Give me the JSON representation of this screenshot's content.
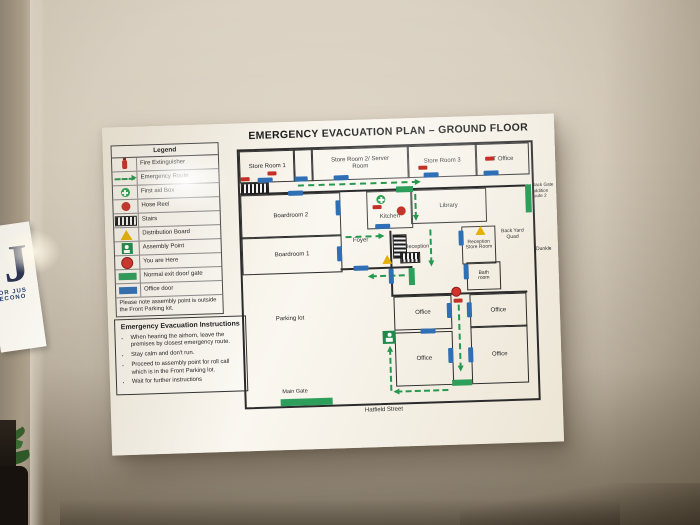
{
  "wall": {
    "sign_letter": "J",
    "sign_line1": "OR JUS",
    "sign_line2": "ECONO"
  },
  "poster": {
    "title": "EMERGENCY EVACUATION PLAN – GROUND FLOOR",
    "legend": {
      "title": "Legend",
      "items": [
        {
          "icon": "fire-extinguisher-icon",
          "label": "Fire Extinguisher"
        },
        {
          "icon": "emergency-route-icon",
          "label": "Emergency Route"
        },
        {
          "icon": "first-aid-box-icon",
          "label": "First aid Box"
        },
        {
          "icon": "hose-reel-icon",
          "label": "Hose Reel"
        },
        {
          "icon": "stairs-icon",
          "label": "Stairs"
        },
        {
          "icon": "distribution-board-icon",
          "label": "Distribution Board"
        },
        {
          "icon": "assembly-point-icon",
          "label": "Assembly Point"
        },
        {
          "icon": "you-are-here-icon",
          "label": "You are Here"
        },
        {
          "icon": "normal-exit-door-icon",
          "label": "Normal exit door/ gate"
        },
        {
          "icon": "office-door-icon",
          "label": "Office door"
        }
      ],
      "note": "Please note assembly point is outside the Front Parking lot."
    },
    "instructions": {
      "title": "Emergency Evacuation Instructions",
      "bullets": [
        "When hearing the airhorn, leave the premises by closest emergency route.",
        "Stay calm and don't run.",
        "Proceed to assembly point for roll call which is in the Front Parking lot.",
        "Wait for further instructions"
      ]
    },
    "plan": {
      "rooms": {
        "store_room_1": "Store Room 1",
        "store_room_2": "Store Room 2/ Server Room",
        "store_room_3": "Store Room 3",
        "it_office": "IT Office",
        "boardroom_2": "Boardroom 2",
        "boardroom_1": "Boardroom 1",
        "kitchen": "Kitchen",
        "library": "Library",
        "foyer": "Foyer",
        "reception": "Reception",
        "reception_store_room": "Reception Store Room",
        "bathroom": "Bath room",
        "back_yard_quad": "Back Yard Quad",
        "office": "Office",
        "parking_lot": "Parking lot"
      },
      "labels": {
        "main_gate": "Main Gate",
        "hatfield_street": "Hatfield Street",
        "side_street": "Dunkle",
        "back_gate_note": "Back Gate addition route 2"
      }
    }
  }
}
